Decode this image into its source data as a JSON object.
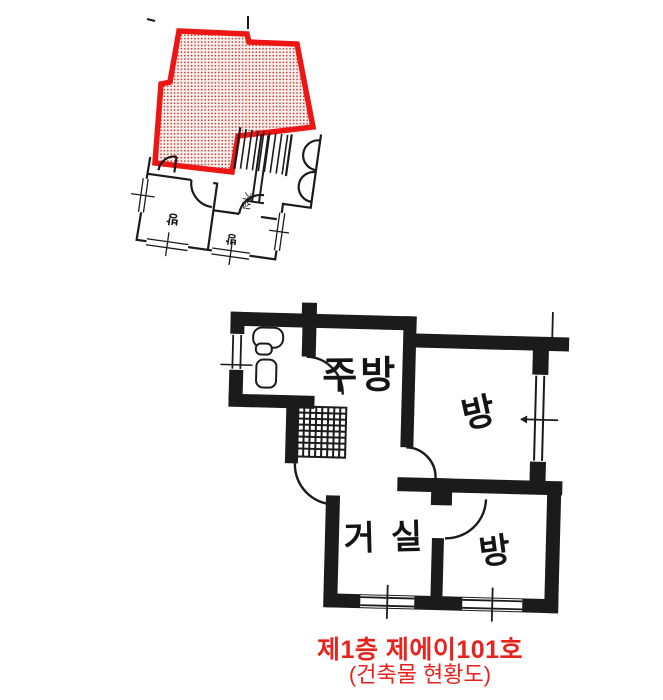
{
  "document": {
    "background": "#ffffff",
    "wall_color": "#1b1b1b",
    "highlight_outline_color": "#ee1515",
    "highlight_dot_color": "#c0392b"
  },
  "site_plan": {
    "description": "small rotated building key plan with highlighted unit",
    "labels": {
      "room_a": "방",
      "room_b": "방",
      "hall": "거실"
    }
  },
  "unit_plan": {
    "description": "enlarged unit floor plan",
    "labels": {
      "kitchen": "주방",
      "room_top_right": "방",
      "living": "거실",
      "room_bottom_right": "방"
    }
  },
  "caption": {
    "title": "제1층 제에이101호",
    "subtitle": "(건축물 현황도)",
    "color": "#e8221c"
  }
}
